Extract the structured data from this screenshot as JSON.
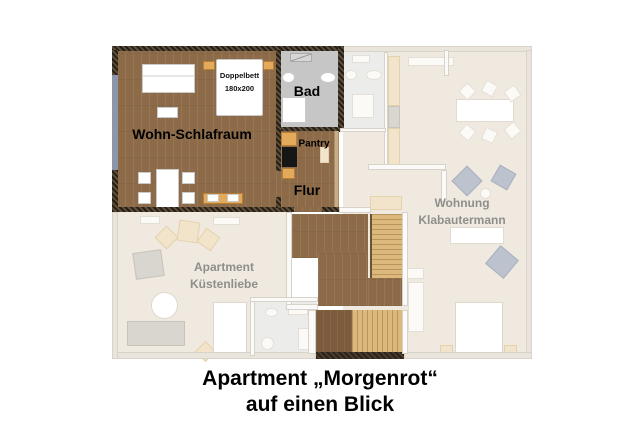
{
  "colors": {
    "wood": "#8d6b49",
    "wood-dark": "#7c5c3d",
    "wall-dark": "#3a322a",
    "stairs": "#ddb87c",
    "tread": "#b8945f",
    "bath": "#c6c6c6",
    "faded": "#f0e9e0",
    "fwall": "#e9e4dc",
    "tan": "#e3aa5c",
    "ftan": "#f2e4ca",
    "bgray": "#bcc3ce",
    "win": "#8c95a9",
    "lgray": "#8e8e8b",
    "ink": "#000000"
  },
  "floorplan": {
    "apartment": {
      "living_room": "Wohn-Schlafraum",
      "bed_line1": "Doppelbett",
      "bed_line2": "180x200",
      "bathroom": "Bad",
      "pantry": "Pantry",
      "hallway": "Flur"
    },
    "neighbor_units": {
      "right_line1": "Wohnung",
      "right_line2": "Klabautermann",
      "left_line1": "Apartment",
      "left_line2": "Küstenliebe"
    }
  },
  "caption": {
    "line1": "Apartment „Morgenrot“",
    "line2": "auf einen Blick"
  }
}
